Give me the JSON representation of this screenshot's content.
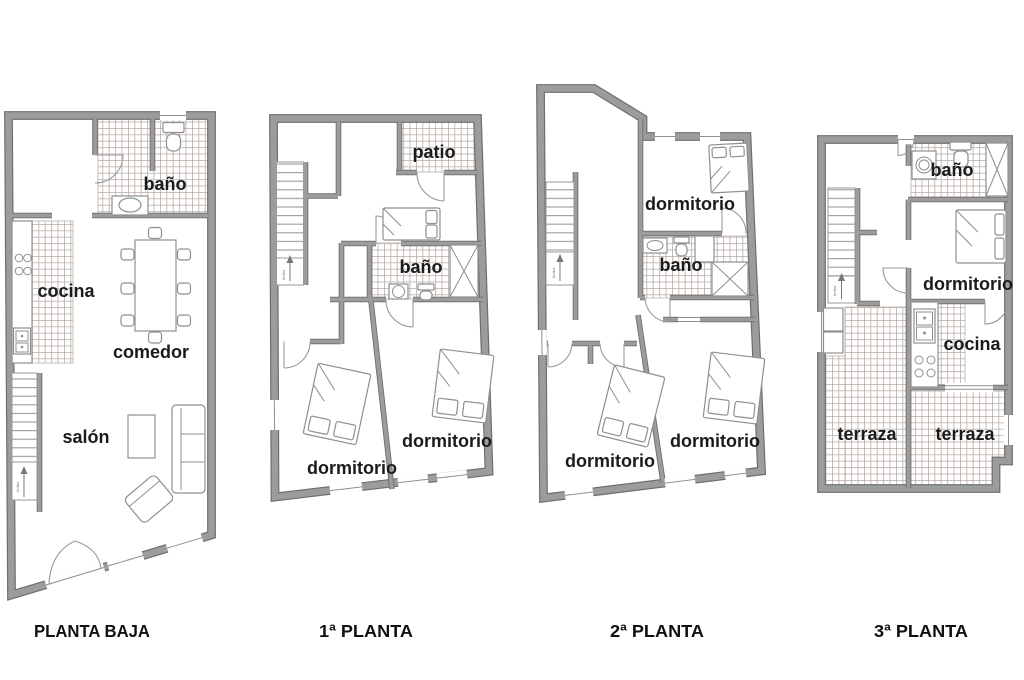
{
  "image": {
    "width": 1024,
    "height": 680
  },
  "colors": {
    "background": "#ffffff",
    "wall_fill": "#9c9c9c",
    "wall_outline": "#6e6e6e",
    "tile_grout": "#b7a9a1",
    "thin_line": "#8f8f8f",
    "label_text": "#1b1b1b"
  },
  "floors": [
    {
      "title": "PLANTA BAJA",
      "stair_note": "Arriba",
      "rooms": {
        "bano": "baño",
        "cocina": "cocina",
        "comedor": "comedor",
        "salon": "salón"
      }
    },
    {
      "title": "1ª PLANTA",
      "stair_note": "Arriba",
      "rooms": {
        "patio": "patio",
        "bano": "baño",
        "dormitorio_left": "dormitorio",
        "dormitorio_right": "dormitorio"
      }
    },
    {
      "title": "2ª PLANTA",
      "stair_note": "Arriba",
      "rooms": {
        "dormitorio_top": "dormitorio",
        "bano": "baño",
        "dormitorio_left": "dormitorio",
        "dormitorio_right": "dormitorio"
      }
    },
    {
      "title": "3ª PLANTA",
      "stair_note": "Arriba",
      "rooms": {
        "bano": "baño",
        "dormitorio": "dormitorio",
        "cocina": "cocina",
        "terraza_left": "terraza",
        "terraza_right": "terraza"
      }
    }
  ]
}
